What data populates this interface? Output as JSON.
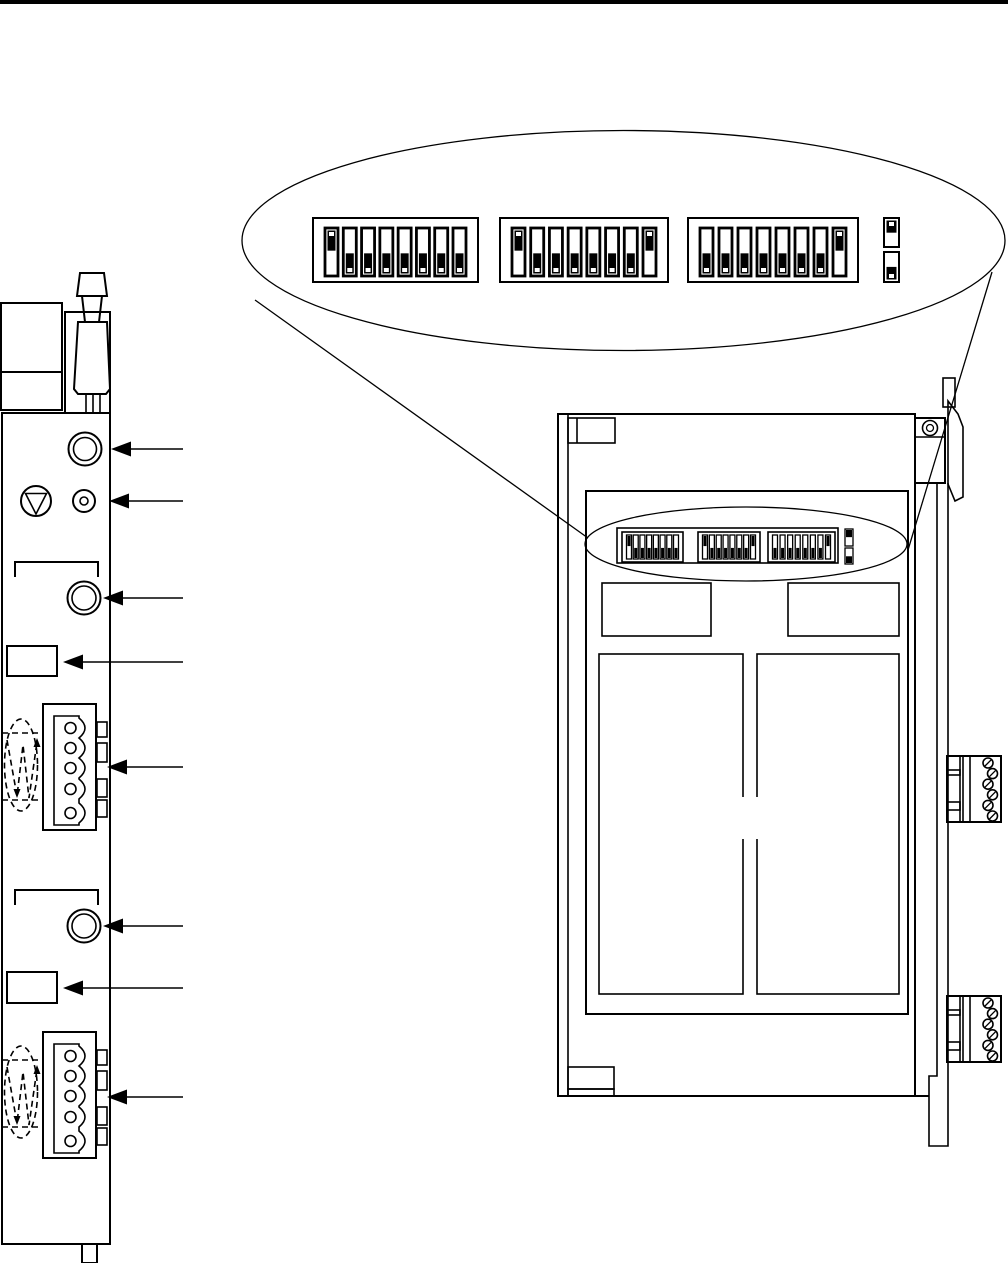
{
  "figure": "module-dip-switch-location-diagram",
  "colors": {
    "background": "#ffffff",
    "ink": "#000000"
  },
  "page_rule": {
    "present": true
  },
  "dip_detail_callout": {
    "banks": [
      {
        "name": "dip-bank-1",
        "switches": [
          "up",
          "down",
          "down",
          "down",
          "down",
          "down",
          "down",
          "down"
        ]
      },
      {
        "name": "dip-bank-2",
        "switches": [
          "up",
          "down",
          "down",
          "down",
          "down",
          "down",
          "down",
          "up"
        ]
      },
      {
        "name": "dip-bank-3",
        "switches": [
          "down",
          "down",
          "down",
          "down",
          "down",
          "down",
          "down",
          "up"
        ]
      }
    ],
    "single_switches": [
      {
        "name": "single-switch-1",
        "state": "up"
      },
      {
        "name": "single-switch-2",
        "state": "down"
      }
    ]
  },
  "front_panel": {
    "callout_arrows": [
      {
        "target": "antenna-connector"
      },
      {
        "target": "status-led"
      },
      {
        "target": "upper-bnc-connector"
      },
      {
        "target": "upper-label"
      },
      {
        "target": "upper-terminal-block"
      },
      {
        "target": "lower-bnc-connector"
      },
      {
        "target": "lower-label"
      },
      {
        "target": "lower-terminal-block"
      }
    ],
    "terminal_blocks": [
      {
        "name": "upper-terminal-block",
        "holes": 5,
        "side_tabs": 4
      },
      {
        "name": "lower-terminal-block",
        "holes": 5,
        "side_tabs": 4
      }
    ],
    "twisted_pair_symbols": 2
  },
  "module_side_view": {
    "mini_dip_banks_mirror_callout": true,
    "component_blocks": {
      "small": 2,
      "large": 2
    },
    "side_terminal_blocks": [
      {
        "name": "side-terminal-block-1",
        "screws": 6
      },
      {
        "name": "side-terminal-block-2",
        "screws": 6
      }
    ],
    "din_latch": {
      "screw": 1
    }
  }
}
